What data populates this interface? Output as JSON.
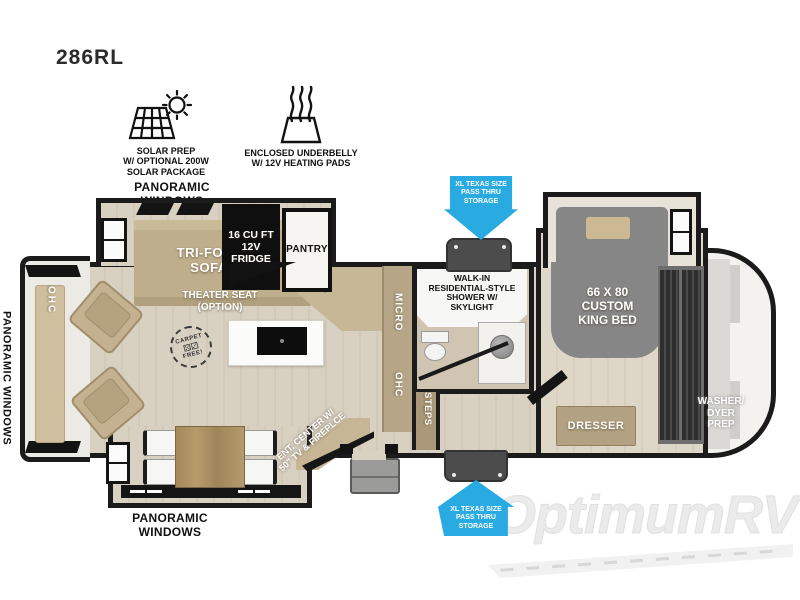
{
  "model": "286RL",
  "features": {
    "solar": "SOLAR PREP\nW/ OPTIONAL 200W\nSOLAR PACKAGE",
    "underbelly": "ENCLOSED UNDERBELLY\nW/ 12V HEATING PADS"
  },
  "exterior": {
    "panoramic_top": "PANORAMIC WINDOWS",
    "panoramic_left": "PANORAMIC WINDOWS",
    "panoramic_bottom": "PANORAMIC WINDOWS",
    "pass_thru_top": "XL TEXAS SIZE\nPASS THRU\nSTORAGE",
    "pass_thru_bottom": "XL TEXAS SIZE\nPASS THRU\nSTORAGE"
  },
  "rooms": {
    "sofa": "TRI-FOLD\nSOFA",
    "fridge": "16 CU FT\n12V\nFRIDGE",
    "pantry": "PANTRY",
    "theater_seat": "THEATER SEAT\n(OPTION)",
    "carpet_free_top": "CARPET",
    "carpet_free_dice": "⚄⚂",
    "carpet_free_bottom": "FREE!",
    "micro": "MICRO",
    "ohc_kitchen": "OHC",
    "ohc_rear": "OHC",
    "shower": "WALK-IN\nRESIDENTIAL-STYLE\nSHOWER W/\nSKYLIGHT",
    "king_bed": "66 X 80\nCUSTOM\nKING BED",
    "dresser": "DRESSER",
    "washer_prep": "WASHER/\nDYER\nPREP",
    "steps": "STEPS",
    "ent_center": "ENT. CENTER W/\n50\" TV & FIREPLCE"
  },
  "watermark": "OptimumRV",
  "colors": {
    "wall": "#1b1b1b",
    "floor": "#d7cfc0",
    "tan": "#c2b08d",
    "arrow-blue": "#29abe2",
    "bed-gray": "#868686",
    "storage-gray": "#4c4c4c",
    "watermark-gray": "#ebebeb"
  }
}
